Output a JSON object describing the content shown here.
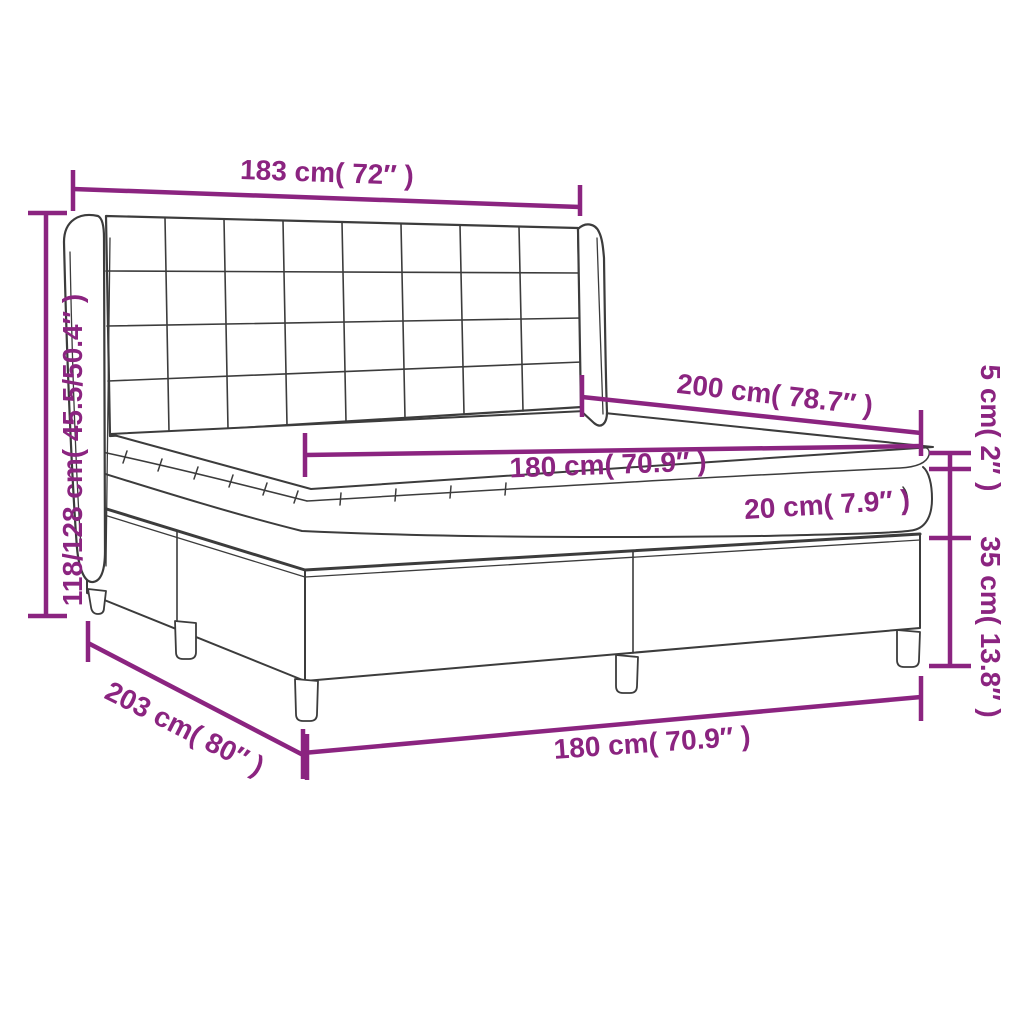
{
  "colors": {
    "accent": "#8b2480",
    "line_art": "#3c3c3c",
    "background": "#ffffff"
  },
  "dimension_labels": {
    "headboard_width": "183 cm( 72″ )",
    "overall_height": "118/128 cm( 45.5/50.4″ )",
    "mattress_length": "200 cm( 78.7″ )",
    "mattress_width": "180 cm( 70.9″ )",
    "mattress_height": "20 cm( 7.9″ )",
    "topper_height": "5 cm( 2″ )",
    "base_height": "35 cm( 13.8″ )",
    "frame_length": "203 cm( 80″ )",
    "frame_width": "180 cm( 70.9″ )"
  }
}
